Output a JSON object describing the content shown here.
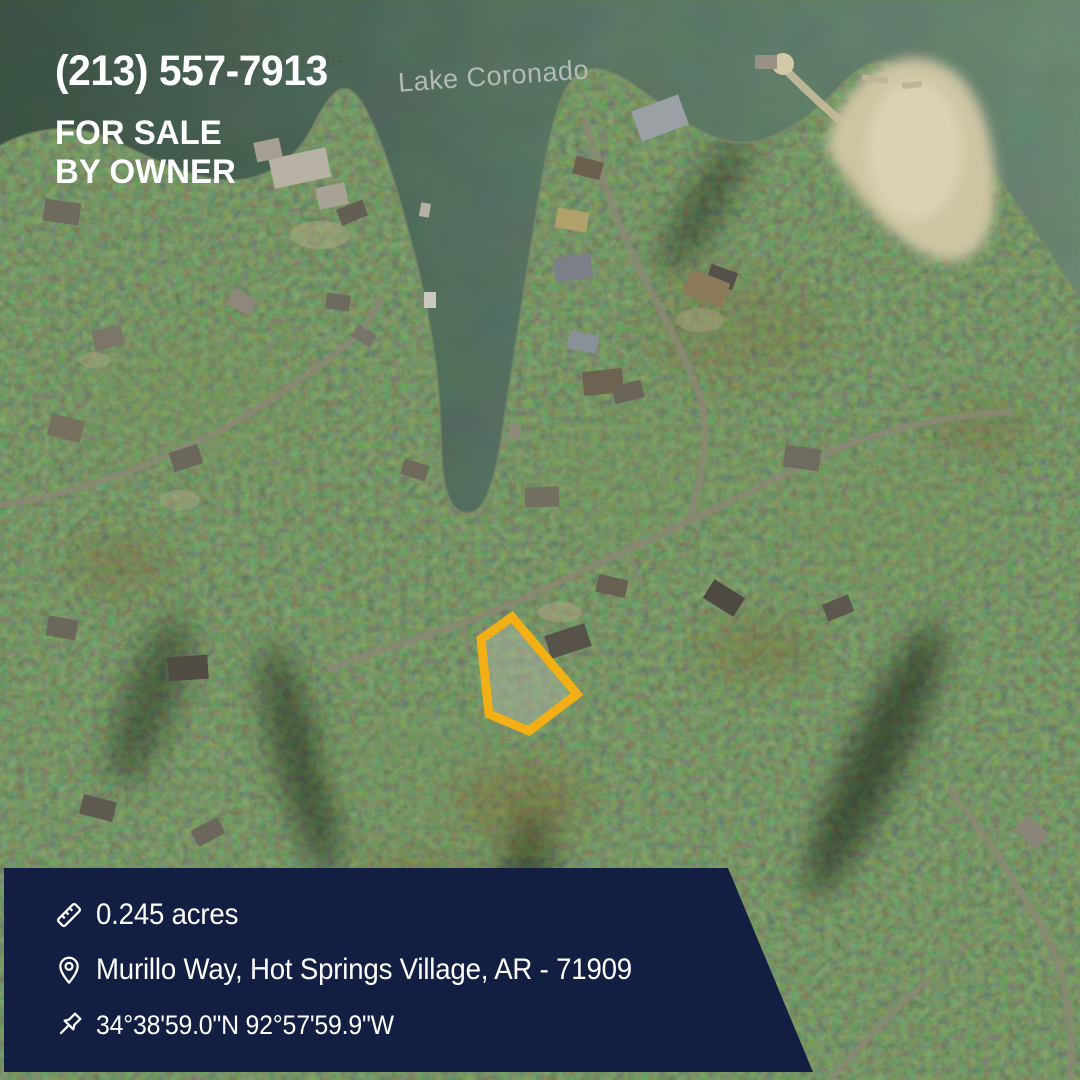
{
  "overlay": {
    "phone": "(213) 557-7913",
    "for_sale_line1": "FOR SALE",
    "for_sale_line2": "BY OWNER",
    "text_color": "#FFFFFF"
  },
  "map": {
    "type": "satellite",
    "lake_label": "Lake Coronado",
    "watermark": "© 2022 Google",
    "parcel": {
      "outline_color": "#F3AF16"
    }
  },
  "info_panel": {
    "background_color": "#121F42",
    "acreage": {
      "icon": "ruler-icon",
      "text": "0.245 acres"
    },
    "address": {
      "icon": "location-pin-icon",
      "text": "Murillo Way, Hot Springs Village, AR - 71909"
    },
    "coordinates": {
      "icon": "pushpin-icon",
      "text": "34°38'59.0\"N 92°57'59.9\"W"
    }
  }
}
